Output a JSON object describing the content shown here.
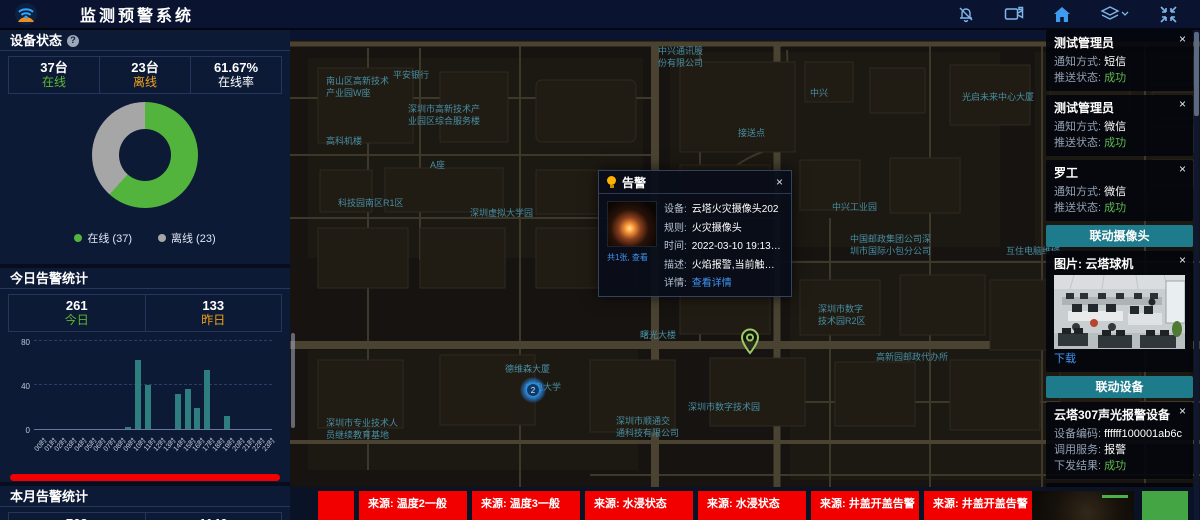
{
  "ui": {
    "close_glyph": "×"
  },
  "header": {
    "title": "监测预警系统"
  },
  "left_panel": {
    "device_status": {
      "title": "设备状态",
      "cells": [
        {
          "value": "37台",
          "label": "在线",
          "label_color": "#5eb832"
        },
        {
          "value": "23台",
          "label": "离线",
          "label_color": "#f0a21a"
        },
        {
          "value": "61.67%",
          "label": "在线率",
          "label_color": "#ffffff"
        }
      ]
    },
    "today_alarms": {
      "title": "今日告警统计",
      "cells": [
        {
          "value": "261",
          "label": "今日",
          "label_color": "#5eb832"
        },
        {
          "value": "133",
          "label": "昨日",
          "label_color": "#f0a21a"
        }
      ],
      "unprocessed_label": "未处理(261个)",
      "processed_label": "已处理(0个)",
      "unprocessed_color": "#f20000",
      "processed_color": "#52c41a"
    },
    "month_alarms": {
      "title": "本月告警统计",
      "cells": [
        {
          "value": "763"
        },
        {
          "value": "1146"
        }
      ]
    }
  },
  "chart_data": [
    {
      "type": "pie",
      "donut": true,
      "title": "设备在线状态",
      "labels": [
        "在线 (37)",
        "离线 (23)"
      ],
      "values": [
        37,
        23
      ],
      "colors": [
        "#52b43c",
        "#a6a6a6"
      ],
      "legend_position": "bottom"
    },
    {
      "type": "bar",
      "title": "今日告警按小时分布",
      "categories": [
        "00时",
        "01时",
        "02时",
        "03时",
        "04时",
        "05时",
        "06时",
        "07时",
        "08时",
        "09时",
        "10时",
        "11时",
        "12时",
        "13时",
        "14时",
        "15时",
        "16时",
        "17时",
        "18时",
        "19时",
        "20时",
        "21时",
        "22时",
        "23时"
      ],
      "values": [
        0,
        0,
        0,
        0,
        0,
        0,
        0,
        0,
        0,
        2,
        63,
        40,
        0,
        0,
        32,
        36,
        19,
        54,
        0,
        12,
        0,
        0,
        0,
        0
      ],
      "xlabel": "",
      "ylabel": "",
      "ylim": [
        0,
        80
      ],
      "yticks": [
        0,
        40,
        80
      ],
      "bar_color": "#2e7d7f",
      "grid": "dashed"
    }
  ],
  "map": {
    "cluster_count": "2",
    "labels": [
      {
        "text": "中兴通讯股\n份有限公司",
        "x": 368,
        "y": 16
      },
      {
        "text": "中兴",
        "x": 520,
        "y": 58
      },
      {
        "text": "光启未来中心大厦",
        "x": 672,
        "y": 62
      },
      {
        "text": "平安银行",
        "x": 103,
        "y": 40
      },
      {
        "text": "南山区高新技术\n产业园W座",
        "x": 36,
        "y": 46
      },
      {
        "text": "深圳市高新技术产\n业园区综合服务楼",
        "x": 118,
        "y": 74
      },
      {
        "text": "高科机楼",
        "x": 36,
        "y": 106
      },
      {
        "text": "接送点",
        "x": 448,
        "y": 98
      },
      {
        "text": "A座",
        "x": 140,
        "y": 130
      },
      {
        "text": "科技园南区R1区",
        "x": 48,
        "y": 168
      },
      {
        "text": "深圳虚拟大学园",
        "x": 180,
        "y": 178
      },
      {
        "text": "中兴工业园",
        "x": 542,
        "y": 172
      },
      {
        "text": "中国邮政集团公司深\n圳市国际小包分公司",
        "x": 560,
        "y": 204
      },
      {
        "text": "互住电脑维修",
        "x": 716,
        "y": 216
      },
      {
        "text": "深圳市数字\n技术园R2区",
        "x": 528,
        "y": 274
      },
      {
        "text": "高新园邮政代办所",
        "x": 586,
        "y": 322
      },
      {
        "text": "德维森大厦",
        "x": 215,
        "y": 334
      },
      {
        "text": "曙光大楼",
        "x": 350,
        "y": 300
      },
      {
        "text": "中电大学",
        "x": 235,
        "y": 352
      },
      {
        "text": "深圳市数字技术园",
        "x": 398,
        "y": 372
      },
      {
        "text": "深圳市顺通交\n通科技有限公司",
        "x": 326,
        "y": 386
      },
      {
        "text": "深圳市专业技术人\n员继续教育基地",
        "x": 36,
        "y": 388
      }
    ]
  },
  "popup": {
    "title": "告警",
    "thumb_caption": "共1张, 查看",
    "fields": [
      {
        "label": "设备:",
        "value": "云塔火灾摄像头202"
      },
      {
        "label": "规则:",
        "value": "火灾摄像头"
      },
      {
        "label": "时间:",
        "value": "2022-03-10 19:13:07"
      },
      {
        "label": "描述:",
        "value": "火焰报警,当前触发值为..."
      },
      {
        "label": "详情:",
        "value": "查看详情",
        "link": true
      }
    ]
  },
  "right_panel": {
    "notify_cards": [
      {
        "title": "测试管理员",
        "rows": [
          {
            "label": "通知方式: ",
            "value": "短信"
          },
          {
            "label": "推送状态: ",
            "value": "成功",
            "ok": true
          }
        ]
      },
      {
        "title": "测试管理员",
        "rows": [
          {
            "label": "通知方式: ",
            "value": "微信"
          },
          {
            "label": "推送状态: ",
            "value": "成功",
            "ok": true
          }
        ]
      },
      {
        "title": "罗工",
        "rows": [
          {
            "label": "通知方式: ",
            "value": "微信"
          },
          {
            "label": "推送状态: ",
            "value": "成功",
            "ok": true
          }
        ]
      }
    ],
    "camera_section": {
      "header": "联动摄像头",
      "card_title": "图片: 云塔球机",
      "download_label": "下载"
    },
    "device_section": {
      "header": "联动设备",
      "cards": [
        {
          "title": "云塔307声光报警设备",
          "rows": [
            {
              "label": "设备编码: ",
              "value": "ffffff100001ab6c"
            },
            {
              "label": "调用服务: ",
              "value": "报警"
            },
            {
              "label": "下发结果: ",
              "value": "成功",
              "ok": true
            }
          ]
        },
        {
          "title": "SIP壁挂音箱1105",
          "rows": [
            {
              "label": "设备编码: ",
              "value": "1105"
            }
          ]
        }
      ]
    }
  },
  "bottom_strip": {
    "tiles": [
      "",
      "来源: 温度2一般",
      "来源: 温度3一般",
      "来源: 水浸状态",
      "来源: 水浸状态",
      "来源: 井盖开盖告警",
      "来源: 井盖开盖告警"
    ]
  }
}
